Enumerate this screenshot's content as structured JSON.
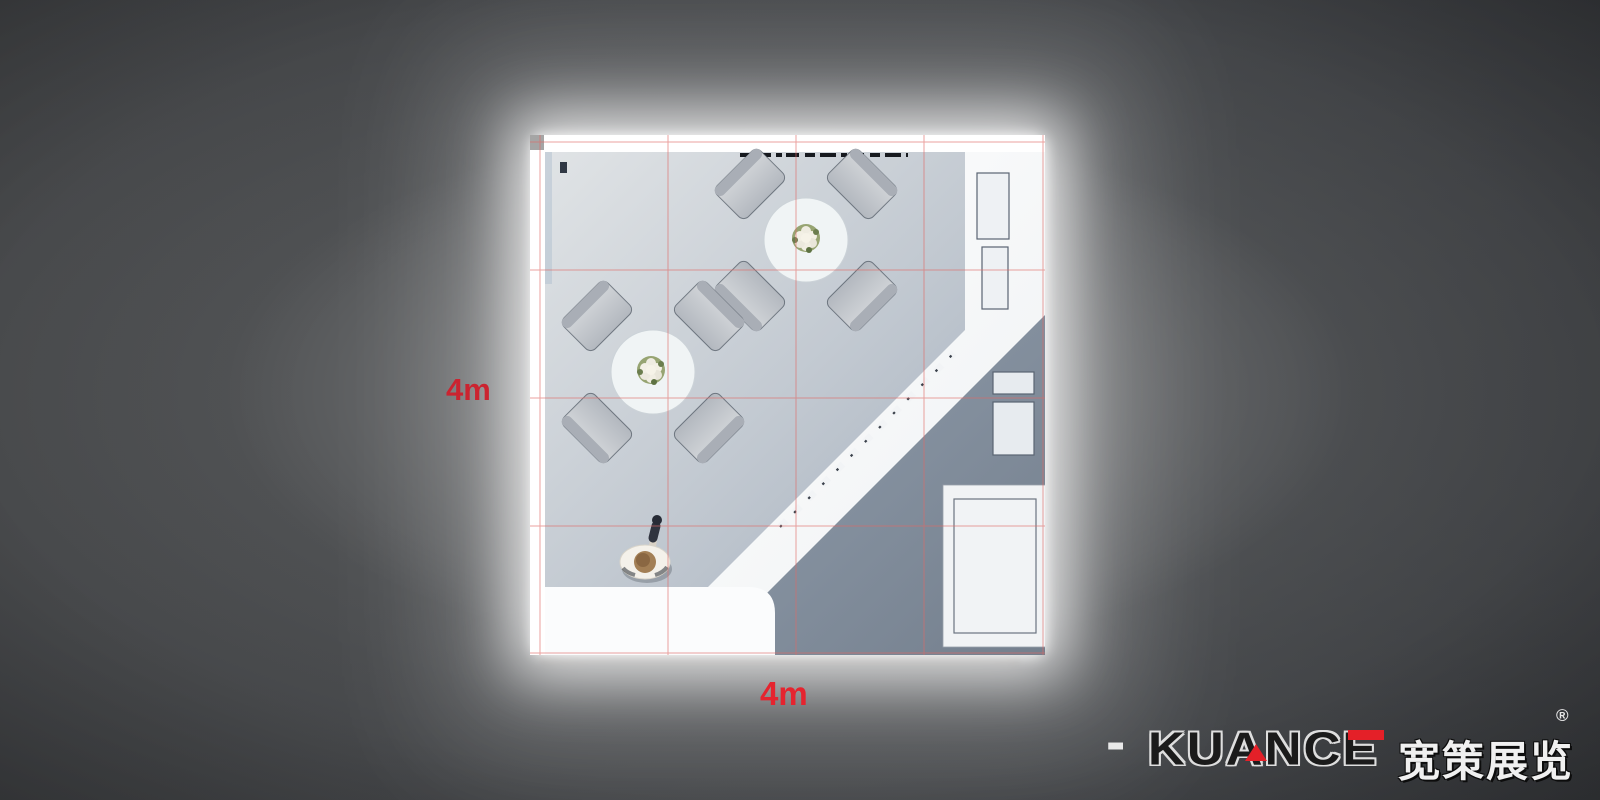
{
  "scene": {
    "description": "Top-down 3D render of a 4m x 4m exhibition booth design",
    "background_color": "#3b3c3e",
    "glow_color": "#ffffff"
  },
  "dimensions": {
    "left_label": "4m",
    "bottom_label": "4m",
    "left_label_color": "#cb2430",
    "bottom_label_color": "#e5242f"
  },
  "grid": {
    "rows": 4,
    "cols": 4,
    "line_color": "#df6a66"
  },
  "booth": {
    "wall_color": "#ffffff",
    "floor_light": "#e0e3e5",
    "floor_dark": "#9da9b8",
    "tables": [
      {
        "shape": "round",
        "chairs": 4,
        "centerpiece": "flower-bouquet"
      },
      {
        "shape": "round",
        "chairs": 4,
        "centerpiece": "flower-bouquet"
      }
    ],
    "person": {
      "pose": "standing top view, arm raised",
      "top_color": "#f4f1ea"
    },
    "fixtures": [
      "dashed-light-track",
      "right-counter-cabinets",
      "diagonal-partition-wall",
      "back-cabinets",
      "storage-box-roof",
      "reception-desk"
    ]
  },
  "logo": {
    "prefix_dash": "-",
    "brand": "KUANCE",
    "brand_cn": "宽策展览",
    "registered_mark": "®",
    "accent_color": "#e42028",
    "outline_color": "#dedede"
  }
}
